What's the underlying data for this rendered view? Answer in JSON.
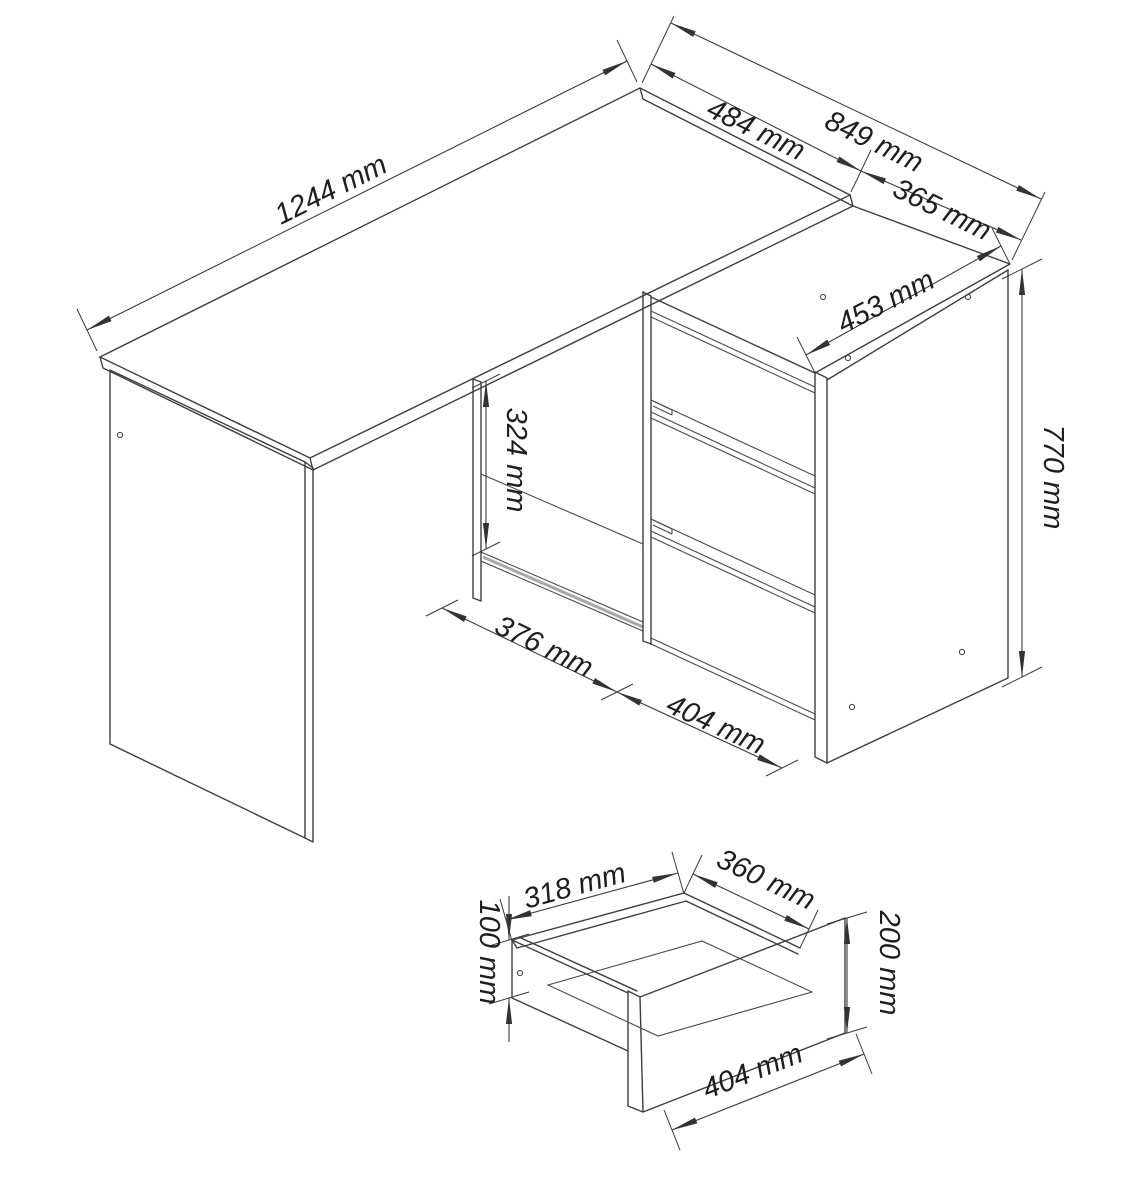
{
  "document": {
    "kind": "furniture technical drawing",
    "background_color": "#ffffff",
    "line_color": "#3e3e3e",
    "unit": "mm"
  },
  "desk_view": {
    "name": "corner-desk-with-drawer-cabinet",
    "labels": {
      "width_1244": "1244 mm",
      "depth_484": "484 mm",
      "depth_849": "849 mm",
      "depth_365": "365 mm",
      "cabinet_top_453": "453 mm",
      "height_770": "770 mm",
      "opening_height_324": "324 mm",
      "opening_width_376": "376 mm",
      "drawer_width_404": "404 mm"
    }
  },
  "drawer_view": {
    "name": "drawer-box-detail",
    "labels": {
      "inner_width_318": "318 mm",
      "inner_depth_360": "360 mm",
      "side_height_100": "100 mm",
      "front_height_200": "200 mm",
      "front_width_404": "404 mm"
    }
  }
}
